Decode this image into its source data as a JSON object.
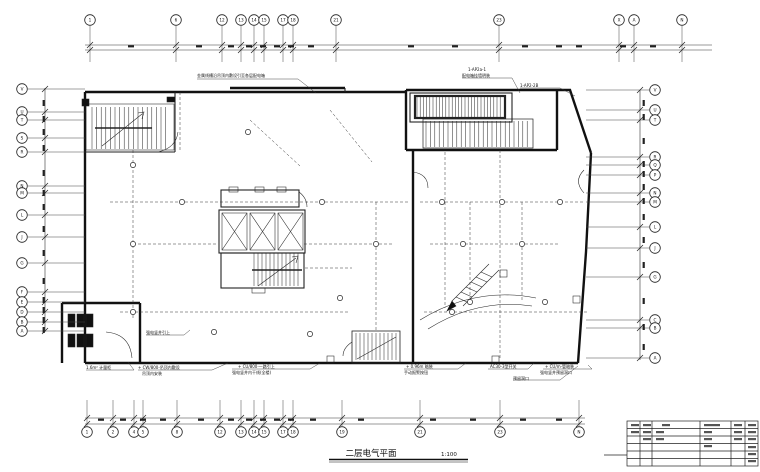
{
  "drawing": {
    "title": "二层电气平面",
    "scale": "1:100",
    "colors": {
      "ink": "#111111",
      "background": "#ffffff"
    },
    "axes": {
      "top": [
        {
          "label": "1",
          "x": 90
        },
        {
          "label": "6",
          "x": 176
        },
        {
          "label": "12",
          "x": 222
        },
        {
          "label": "13",
          "x": 241
        },
        {
          "label": "14",
          "x": 254
        },
        {
          "label": "15",
          "x": 264
        },
        {
          "label": "17",
          "x": 283
        },
        {
          "label": "18",
          "x": 293
        },
        {
          "label": "21",
          "x": 336
        },
        {
          "label": "23",
          "x": 499
        },
        {
          "label": "X",
          "x": 619
        },
        {
          "label": "A",
          "x": 634
        },
        {
          "label": "N",
          "x": 682
        }
      ],
      "bottom": [
        {
          "label": "1",
          "x": 87
        },
        {
          "label": "2",
          "x": 113
        },
        {
          "label": "4",
          "x": 134
        },
        {
          "label": "5",
          "x": 143
        },
        {
          "label": "8",
          "x": 177
        },
        {
          "label": "12",
          "x": 220
        },
        {
          "label": "13",
          "x": 241
        },
        {
          "label": "14",
          "x": 254
        },
        {
          "label": "15",
          "x": 264
        },
        {
          "label": "17",
          "x": 283
        },
        {
          "label": "18",
          "x": 293
        },
        {
          "label": "19",
          "x": 342
        },
        {
          "label": "21",
          "x": 420
        },
        {
          "label": "23",
          "x": 500
        },
        {
          "label": "N",
          "x": 579
        }
      ],
      "left": [
        {
          "label": "V",
          "y": 89
        },
        {
          "label": "U",
          "y": 112
        },
        {
          "label": "T",
          "y": 120
        },
        {
          "label": "S",
          "y": 138
        },
        {
          "label": "R",
          "y": 152
        },
        {
          "label": "N",
          "y": 186
        },
        {
          "label": "M",
          "y": 193
        },
        {
          "label": "L",
          "y": 215
        },
        {
          "label": "J",
          "y": 237
        },
        {
          "label": "G",
          "y": 263
        },
        {
          "label": "F",
          "y": 292
        },
        {
          "label": "E",
          "y": 302
        },
        {
          "label": "D",
          "y": 312
        },
        {
          "label": "B",
          "y": 322
        },
        {
          "label": "A",
          "y": 331
        }
      ],
      "right": [
        {
          "label": "V",
          "y": 90
        },
        {
          "label": "U",
          "y": 110
        },
        {
          "label": "T",
          "y": 120
        },
        {
          "label": "R",
          "y": 157
        },
        {
          "label": "Q",
          "y": 165
        },
        {
          "label": "P",
          "y": 175
        },
        {
          "label": "N",
          "y": 193
        },
        {
          "label": "M",
          "y": 202
        },
        {
          "label": "L",
          "y": 227
        },
        {
          "label": "J",
          "y": 248
        },
        {
          "label": "G",
          "y": 277
        },
        {
          "label": "C",
          "y": 320
        },
        {
          "label": "B",
          "y": 328
        },
        {
          "label": "A",
          "y": 358
        }
      ]
    },
    "annotations": [
      {
        "x": 197,
        "y": 77,
        "text": "金属线槽沿吊顶内敷设引至各层配电箱"
      },
      {
        "x": 468,
        "y": 71,
        "text": "1-AP2a-1"
      },
      {
        "x": 462,
        "y": 77,
        "text": "配电箱挂墙明装"
      },
      {
        "x": 520,
        "y": 87,
        "text": "1-AP2-2B"
      },
      {
        "x": 138,
        "y": 369,
        "text": "+ CW/800-吊顶内敷设"
      },
      {
        "x": 142,
        "y": 375,
        "text": "吊顶内安装"
      },
      {
        "x": 238,
        "y": 368,
        "text": "+ CU/800-一路引上"
      },
      {
        "x": 232,
        "y": 374,
        "text": "强电竖井内干线(全楼)"
      },
      {
        "x": 406,
        "y": 368,
        "text": "+ 0.96m 暗装"
      },
      {
        "x": 404,
        "y": 374,
        "text": "手动报警按钮"
      },
      {
        "x": 490,
        "y": 368,
        "text": "AC30-3型开关"
      },
      {
        "x": 545,
        "y": 368,
        "text": "+ CU/m-管暗装"
      },
      {
        "x": 540,
        "y": 374,
        "text": "强电竖井预留洞口"
      },
      {
        "x": 513,
        "y": 380,
        "text": "预留洞口"
      },
      {
        "x": 86,
        "y": 369,
        "text": "1.6m² 计量柜"
      },
      {
        "x": 146,
        "y": 334,
        "text": "强电竖井引上"
      }
    ]
  }
}
